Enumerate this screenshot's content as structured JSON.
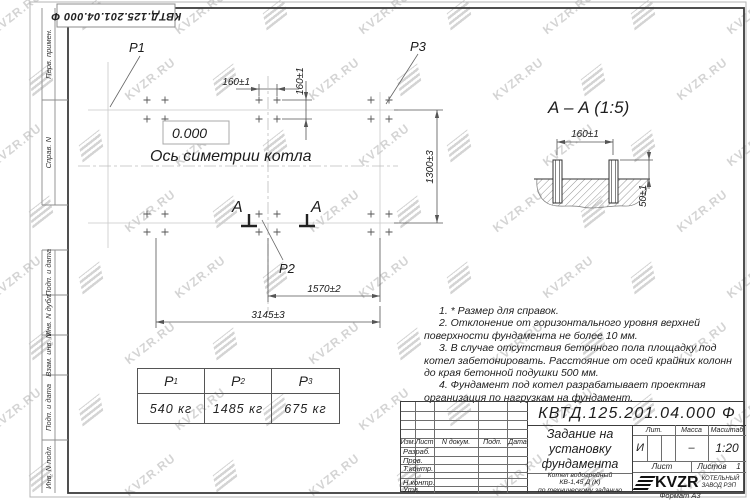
{
  "sheet": {
    "outer_designation": "КВТД.125.201.04.000 Ф",
    "format_note": "Формат А3"
  },
  "watermark": {
    "text": "KVZR.RU"
  },
  "margin_labels": [
    "Перв. примен.",
    "Справ. N",
    "Подп. и дата",
    "Инв. N дубл.",
    "Взам. инв. N",
    "Подп. и дата",
    "Инв. N подл."
  ],
  "plan": {
    "p1": "P1",
    "p2": "P2",
    "p3": "P3",
    "elevation": "0.000",
    "axis_label": "Ось симетрии котла",
    "section_letter": "А",
    "dims": {
      "d160h": "160±1",
      "d160v": "160±1",
      "d1300": "1300±3",
      "d1570": "1570±2",
      "d3145": "3145±3"
    }
  },
  "section_view": {
    "title": "А – А (1:5)",
    "dims": {
      "d160": "160±1",
      "d50": "50±1"
    }
  },
  "notes": [
    "1. * Размер для справок.",
    "2. Отклонение от горизонтального уровня верхней поверхности фундамента не более 10 мм.",
    "3. В случае отсутствия бетонного пола площадку под котел забетонировать. Расстояние от осей крайних колонн до края бетонной подушки 500 мм.",
    "4. Фундамент под котел разрабатывает проектная организация по нагрузкам на фундамент."
  ],
  "loads_table": {
    "headers": [
      {
        "base": "P",
        "sub": "1"
      },
      {
        "base": "P",
        "sub": "2"
      },
      {
        "base": "P",
        "sub": "3"
      }
    ],
    "values": [
      "540 кг",
      "1485 кг",
      "675 кг"
    ]
  },
  "title_block": {
    "designation": "КВТД.125.201.04.000 Ф",
    "doc_title_lines": [
      "Задание на",
      "установку",
      "фундамента"
    ],
    "product_lines": [
      "Котел водогрейный",
      "КВ-1,45 Д (К)",
      "по техническому заданию"
    ],
    "change_header": [
      "Изм.",
      "Лист",
      "N докум.",
      "Подп.",
      "Дата"
    ],
    "sign_rows": [
      "Разраб.",
      "Пров.",
      "Т.контр.",
      "Н.контр.",
      "Утв."
    ],
    "lit_label": "Лит.",
    "mass_label": "Масса",
    "scale_label": "Масштаб",
    "lit_value": "И",
    "mass_value": "–",
    "scale_value": "1:20",
    "sheet_label": "Лист",
    "sheets_label": "Листов",
    "sheets_value": "1",
    "logo_text": "KVZR",
    "company_lines": [
      "КОТЕЛЬНЫЙ",
      "ЗАВОД РЭП"
    ]
  }
}
